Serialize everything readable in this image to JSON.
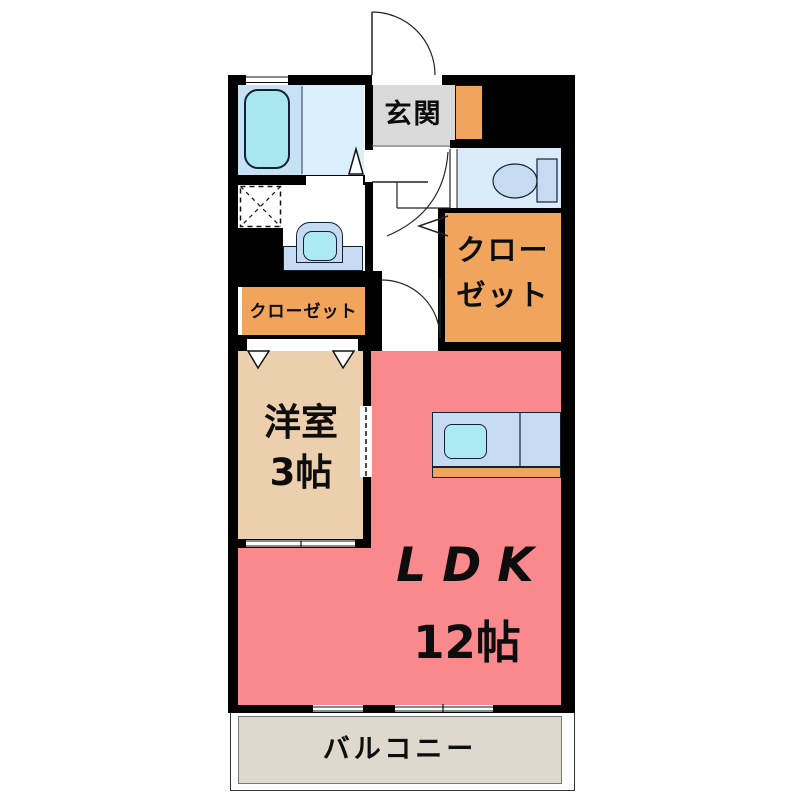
{
  "plan": {
    "type": "japanese-apartment-floor-plan",
    "rooms": {
      "genkan": {
        "label": "玄関"
      },
      "closet_right": {
        "label": "クロー\nゼット"
      },
      "closet_left": {
        "label": "クローゼット"
      },
      "western_room": {
        "label": "洋室\n3帖"
      },
      "ldk": {
        "name": "LDK",
        "size": "12帖"
      },
      "balcony": {
        "label": "バルコニー"
      }
    },
    "fixtures": {
      "bathtub": "bathtub",
      "washing_machine_space": "washing-machine-space",
      "washbasin": "washbasin",
      "toilet": "toilet",
      "kitchen_counter_sink": "kitchen-counter-with-sink",
      "shoe_cabinet": "shoe-cabinet",
      "entrance_door": "entrance-door-swing"
    },
    "colors": {
      "wall": "#000000",
      "ldk_floor": "#f9898c",
      "western_room_floor": "#ecd0ae",
      "closet_fill": "#f0a45c",
      "genkan_fill": "#dadada",
      "balcony_fill": "#ded9cc",
      "bath_left": "#c8e2f5",
      "bath_right": "#dbeefb",
      "bathtub_fill": "#a9e7f0",
      "water_fixture_blue": "#c6dbf2",
      "sink_cyan": "#ace9f2",
      "toilet_room": "#dcebfa"
    }
  }
}
